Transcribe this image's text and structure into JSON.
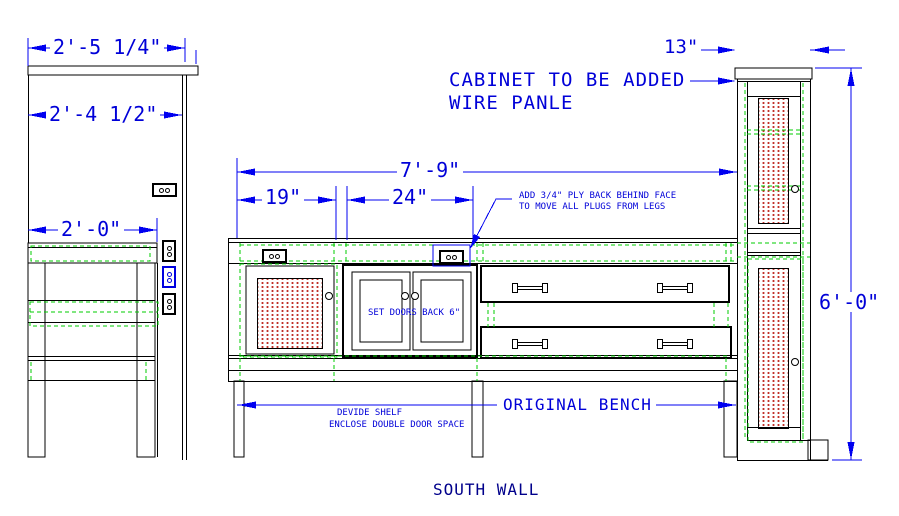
{
  "drawing": {
    "view_title": "SOUTH WALL",
    "colors": {
      "dimension_blue": "#0000e0",
      "highlight_green": "#00cc00",
      "hatch_red": "#c03028",
      "line_black": "#000000"
    },
    "left_elevation": {
      "dim_counter_width": "2'-5 1/4\"",
      "dim_cabinet_width": "2'-4 1/2\"",
      "dim_bench_depth": "2'-0\""
    },
    "bench": {
      "dim_total_length": "7'-9\"",
      "dim_door_section": "19\"",
      "dim_double_door_section": "24\"",
      "label": "ORIGINAL BENCH",
      "note_ply_line1": "ADD 3/4\" PLY BACK BEHIND FACE",
      "note_ply_line2": "TO MOVE ALL PLUGS FROM LEGS",
      "note_set_doors": "SET DOORS BACK 6\"",
      "note_shelf_line1": "DEVIDE SHELF",
      "note_shelf_line2": "ENCLOSE DOUBLE DOOR SPACE"
    },
    "new_cabinet": {
      "note_line1": "CABINET TO BE ADDED",
      "note_line2": "WIRE PANLE",
      "dim_width": "13\"",
      "dim_height": "6'-0\""
    }
  }
}
